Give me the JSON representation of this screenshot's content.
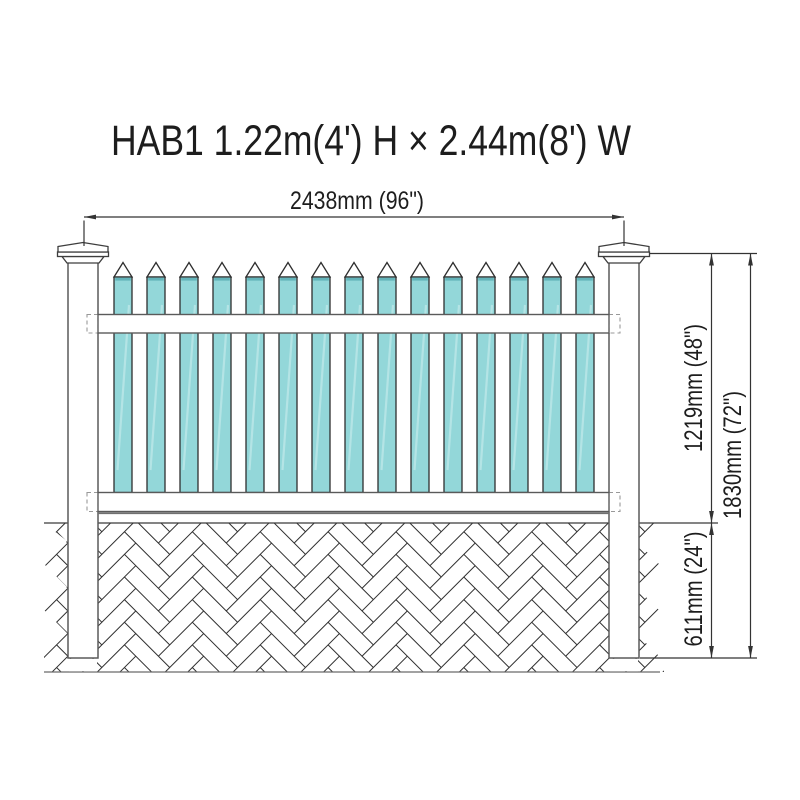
{
  "title": "HAB1 1.22m(4') H × 2.44m(8') W",
  "dimensions": {
    "width": "2438mm (96\")",
    "height_above_ground": "1219mm (48\")",
    "total_height": "1830mm (72\")",
    "depth_below_ground": "611mm (24\")"
  },
  "fence": {
    "picket_count": 15,
    "post_count": 2,
    "rail_count": 2
  },
  "colors": {
    "picket_fill": "#93d7d9",
    "picket_streak": "#c6ebec",
    "picket_top_strip": "#5fb0b6",
    "picket_outline": "#2e2e2e",
    "brick_line": "#2f2f2f",
    "ground_line": "#3a3a3a"
  }
}
